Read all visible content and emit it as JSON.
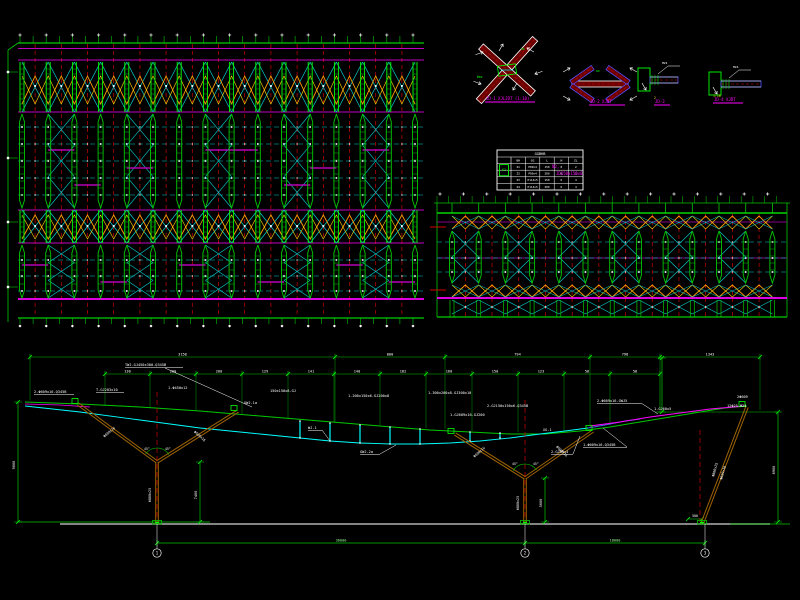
{
  "canvas": {
    "w": 800,
    "h": 600,
    "bg": "#000000"
  },
  "palette": {
    "green": "#00C800",
    "bright_green": "#00FF00",
    "dim_green": "#00A000",
    "magenta": "#FF00FF",
    "dim_magenta": "#B400B4",
    "cyan": "#00D2D2",
    "bright_cyan": "#00FFFF",
    "red": "#D00000",
    "dark_red": "#6B0000",
    "orange": "#FF9900",
    "yellow": "#FFD700",
    "white": "#FFFFFF",
    "gray": "#B0B0B0",
    "brown": "#A06400",
    "blue": "#5050FF"
  },
  "plan_left": {
    "boundary_x": 8,
    "boundary_markers": [
      72,
      158,
      222,
      287
    ],
    "frame_x1": 18,
    "frame_x2": 424,
    "top_y": 43,
    "bot_y": 318,
    "tick_step": 13.1,
    "col_start": 22,
    "col_spacing": 26.2,
    "col_count": 16,
    "magenta_lines": [
      48.5,
      60,
      112,
      210,
      243
    ],
    "bright_magenta_y": 299,
    "xbands": [
      {
        "y1": 62,
        "y2": 112,
        "chev1": 76,
        "chev2": 104,
        "marker_y": 86
      },
      {
        "y1": 210,
        "y2": 243,
        "chev1": 215,
        "chev2": 239,
        "marker_y": 226
      }
    ],
    "zones": [
      {
        "y1": 114,
        "y2": 208,
        "rows": [
          127,
          144,
          161,
          178,
          195
        ],
        "mag_segs": [
          [
            1,
            150
          ],
          [
            4,
            168
          ],
          [
            7,
            150
          ],
          [
            10,
            185
          ],
          [
            13,
            150
          ],
          [
            2,
            185
          ],
          [
            8,
            150
          ],
          [
            11,
            168
          ]
        ]
      },
      {
        "y1": 245,
        "y2": 298,
        "rows": [
          260,
          276,
          291
        ],
        "mag_segs": [
          [
            0,
            265
          ],
          [
            3,
            282
          ],
          [
            6,
            265
          ],
          [
            9,
            282
          ],
          [
            12,
            265
          ],
          [
            14,
            282
          ]
        ]
      }
    ]
  },
  "plan_right": {
    "x1": 437,
    "x2": 787,
    "dots_y": 194,
    "top_line_y": 203,
    "top_y": 213,
    "bot_y": 317,
    "col_start": 452,
    "col_spacing": 26.7,
    "col_count": 13,
    "chev_bands": [
      [
        216,
        229
      ],
      [
        285,
        297
      ]
    ],
    "zone": {
      "y1": 231,
      "y2": 283,
      "rows": [
        242,
        258,
        272
      ]
    },
    "smallx": [
      300,
      314
    ],
    "magenta": [
      222,
      258
    ],
    "bright_magenta_y": 298,
    "red_stubs": [
      227,
      290
    ]
  },
  "details": {
    "items": [
      {
        "id": "d1",
        "type": "xjoint",
        "cx": 507,
        "cy": 70,
        "title": "JD-1 XJLJDT (1:10)",
        "tx": 486,
        "ty": 100,
        "uw": 50
      },
      {
        "id": "d2",
        "type": "flatx",
        "cx": 600,
        "cy": 84,
        "title": "JD-2 XJDT",
        "tx": 590,
        "ty": 103,
        "uw": 36
      },
      {
        "id": "d3",
        "type": "plate",
        "cx": 660,
        "cy": 80,
        "mlen": 28,
        "title": "2",
        "tt": "JD-3",
        "tx": 655,
        "ty": 103,
        "uw": 16
      },
      {
        "id": "d4",
        "type": "plate",
        "cx": 731,
        "cy": 84,
        "mlen": 40,
        "title": "1:10",
        "tt": "JD-4 XJDT",
        "tx": 714,
        "ty": 101,
        "uw": 30
      }
    ]
  },
  "table": {
    "x": 497,
    "y": 150,
    "w": 86,
    "h": 40,
    "title": "GGBHB",
    "headers": [
      "BH",
      "GG",
      "L",
      "N",
      "ZL"
    ],
    "rows": [
      [
        "Z1",
        "P89x4",
        "150",
        "8",
        "2"
      ],
      [
        "Z2",
        "P89x4",
        "200",
        "8",
        "2"
      ],
      [
        "Z3",
        "P114x5",
        "150",
        "6",
        "4"
      ],
      [
        "Z4",
        "P114x5",
        "200",
        "6",
        "4"
      ]
    ],
    "symbol": "K2"
  },
  "notes": {
    "x": 552,
    "y": 168,
    "lines": [
      "N2,",
      "JD150x150x8"
    ]
  },
  "elevation": {
    "ground": {
      "gray": [
        60,
        770,
        524
      ],
      "green_left": [
        18,
        210,
        522
      ],
      "green_right": [
        730,
        790,
        524
      ]
    },
    "chain_a": {
      "y": 357,
      "ticks": [
        30,
        335,
        445,
        590,
        660,
        760
      ],
      "labels": [
        "3158",
        "800",
        "794",
        "798",
        "1343"
      ],
      "ext_y2": [
        402,
        424,
        431,
        427,
        412,
        412
      ]
    },
    "chain_c": {
      "y": 374,
      "ticks": [
        105,
        150,
        196,
        242,
        288,
        334,
        380,
        426,
        472,
        518,
        564,
        610,
        660
      ],
      "labels": [
        "130",
        "200",
        "200",
        "129",
        "141",
        "140",
        "182",
        "160",
        "150",
        "123",
        "58",
        "58"
      ],
      "ext_y2": [
        408,
        410,
        413,
        416,
        420,
        424,
        427,
        430,
        433,
        434,
        433,
        427,
        416
      ]
    },
    "hline412": [
      655,
      778,
      412
    ],
    "vdims": [
      {
        "x": 18,
        "y1": 402,
        "y2": 522,
        "t": "9000",
        "tx": 15,
        "ty": 465
      },
      {
        "x": 200,
        "y1": 462,
        "y2": 522,
        "t": "7400",
        "tx": 197,
        "ty": 495
      },
      {
        "x": 545,
        "y1": 478,
        "y2": 522,
        "t": "5600",
        "tx": 542,
        "ty": 503
      },
      {
        "x": 778,
        "y1": 412,
        "y2": 522,
        "t": "8900",
        "tx": 775,
        "ty": 470
      },
      {
        "x": 662,
        "y1": 358,
        "y2": 412,
        "t": "",
        "tx": 0,
        "ty": 0
      }
    ],
    "hdim": {
      "x1": 688,
      "x2": 702,
      "y": 519,
      "t": "500"
    },
    "chords": {
      "top_green": [
        [
          25,
          402
        ],
        [
          80,
          404
        ],
        [
          140,
          407
        ],
        [
          200,
          411
        ],
        [
          260,
          416
        ],
        [
          320,
          421
        ],
        [
          380,
          426
        ],
        [
          430,
          430
        ],
        [
          470,
          432
        ],
        [
          510,
          434
        ],
        [
          545,
          434
        ],
        [
          580,
          431
        ],
        [
          610,
          427
        ],
        [
          640,
          422
        ],
        [
          670,
          417
        ],
        [
          700,
          412
        ],
        [
          725,
          408
        ],
        [
          747,
          406
        ]
      ],
      "bottom_cyan": [
        [
          25,
          406
        ],
        [
          80,
          412
        ],
        [
          140,
          420
        ],
        [
          200,
          428
        ],
        [
          260,
          434
        ],
        [
          300,
          438
        ],
        [
          330,
          441
        ],
        [
          360,
          443
        ],
        [
          390,
          444
        ],
        [
          420,
          444
        ],
        [
          450,
          443
        ],
        [
          480,
          441
        ],
        [
          510,
          438
        ],
        [
          540,
          434
        ],
        [
          565,
          431
        ],
        [
          588,
          428
        ]
      ],
      "blue_seg": [
        [
          588,
          428
        ],
        [
          605,
          425
        ],
        [
          625,
          421
        ],
        [
          640,
          419
        ]
      ],
      "magenta_right": [
        [
          590,
          426
        ],
        [
          620,
          422
        ],
        [
          650,
          417
        ],
        [
          680,
          413
        ],
        [
          710,
          409
        ],
        [
          745,
          406
        ]
      ],
      "magenta_left": [
        [
          25,
          404
        ],
        [
          60,
          405
        ],
        [
          90,
          407
        ]
      ]
    },
    "struts": [
      [
        300,
        421,
        438
      ],
      [
        330,
        423,
        441
      ],
      [
        360,
        425,
        443
      ],
      [
        390,
        427,
        444
      ],
      [
        420,
        429,
        444
      ],
      [
        470,
        432,
        441
      ],
      [
        500,
        433,
        438
      ]
    ],
    "columns": [
      {
        "trunk": [
          [
            157,
            462
          ],
          [
            157,
            524
          ]
        ],
        "branches": [
          [
            [
              157,
              462
            ],
            [
              78,
              404
            ]
          ],
          [
            [
              157,
              462
            ],
            [
              238,
              411
            ]
          ]
        ],
        "cl": [
          157,
          392,
          522
        ]
      },
      {
        "trunk": [
          [
            525,
            478
          ],
          [
            525,
            524
          ]
        ],
        "branches": [
          [
            [
              525,
              478
            ],
            [
              455,
              434
            ]
          ],
          [
            [
              525,
              478
            ],
            [
              593,
              431
            ]
          ]
        ],
        "cl": [
          525,
          400,
          522
        ]
      },
      {
        "trunk": [
          [
            702,
            524
          ],
          [
            747,
            407
          ]
        ],
        "branches": [],
        "cl": [
          700,
          430,
          522
        ]
      }
    ],
    "joint_rects": [
      [
        75,
        401
      ],
      [
        234,
        408
      ],
      [
        451,
        431
      ],
      [
        589,
        428
      ],
      [
        742,
        404
      ]
    ],
    "arcs": [
      {
        "cx": 157,
        "cy": 462
      },
      {
        "cx": 525,
        "cy": 478
      }
    ],
    "angle_labels": [
      {
        "t": "45°",
        "x": 144,
        "y": 450
      },
      {
        "t": "45°",
        "x": 165,
        "y": 450
      },
      {
        "t": "45°",
        "x": 512,
        "y": 465
      },
      {
        "t": "45°",
        "x": 533,
        "y": 465
      }
    ],
    "rot_labels": [
      {
        "t": "Φ800x25",
        "x": 151,
        "y": 495,
        "r": -90
      },
      {
        "t": "Φ609x16",
        "x": 110,
        "y": 433,
        "r": -40
      },
      {
        "t": "Φ609x16",
        "x": 199,
        "y": 437,
        "r": 42
      },
      {
        "t": "Φ800x25",
        "x": 519,
        "y": 503,
        "r": -90
      },
      {
        "t": "Φ609x16",
        "x": 480,
        "y": 453,
        "r": -42
      },
      {
        "t": "Φ609x16",
        "x": 561,
        "y": 452,
        "r": 44
      },
      {
        "t": "Φ800x25",
        "x": 716,
        "y": 470,
        "r": -75
      },
      {
        "t": "Φ609x16",
        "x": 724,
        "y": 473,
        "r": -75
      }
    ],
    "labels": [
      {
        "t": "2-Φ609x16-Q345B",
        "x": 34,
        "y": 393,
        "u": 40
      },
      {
        "t": "T-GJ203x10",
        "x": 96,
        "y": 391,
        "u": 28
      },
      {
        "t": "TWJ-GJ450x300-Q345B",
        "x": 125,
        "y": 366,
        "u": 58
      },
      {
        "t": "1-Φ450x12",
        "x": 168,
        "y": 389
      },
      {
        "t": "GWJ-1a",
        "x": 244,
        "y": 404
      },
      {
        "t": "150x150x8-GJ",
        "x": 270,
        "y": 392
      },
      {
        "t": "WJ-1",
        "x": 308,
        "y": 429,
        "u": 14
      },
      {
        "t": "1-200x150x6-GJ200x8",
        "x": 348,
        "y": 397
      },
      {
        "t": "GWJ-2a",
        "x": 360,
        "y": 453,
        "u": 20
      },
      {
        "t": "1-300x200x8-GJ300x10",
        "x": 428,
        "y": 394
      },
      {
        "t": "1-GJ609x16-GJ200",
        "x": 450,
        "y": 416
      },
      {
        "t": "2-GJ150x150x6-Q345B",
        "x": 487,
        "y": 407
      },
      {
        "t": "XG-1",
        "x": 543,
        "y": 431
      },
      {
        "t": "2-GJ89x4",
        "x": 551,
        "y": 453,
        "u": 22
      },
      {
        "t": "2-Φ609x16-GWJ5",
        "x": 597,
        "y": 402,
        "u": 44
      },
      {
        "t": "1-Φ609x16-Q345B",
        "x": 583,
        "y": 446,
        "u": 44
      },
      {
        "t": "1-GJ60x5",
        "x": 654,
        "y": 410
      },
      {
        "t": "12Φ25-M24",
        "x": 727,
        "y": 407
      },
      {
        "t": "2Φ609",
        "x": 737,
        "y": 398
      }
    ],
    "leaders": [
      [
        165,
        368,
        252,
        407
      ],
      [
        641,
        403,
        658,
        414
      ],
      [
        627,
        447,
        603,
        428
      ],
      [
        380,
        454,
        396,
        445
      ],
      [
        573,
        454,
        580,
        436
      ],
      [
        322,
        430,
        330,
        441
      ]
    ],
    "bottom_chain": {
      "y": 543,
      "ticks": [
        157,
        525,
        705
      ],
      "labels": [
        "36000",
        "18000"
      ]
    },
    "bubbles": [
      {
        "x": 157,
        "n": "1"
      },
      {
        "x": 525,
        "n": "2"
      },
      {
        "x": 705,
        "n": "3"
      }
    ],
    "bubble_y": 553
  }
}
